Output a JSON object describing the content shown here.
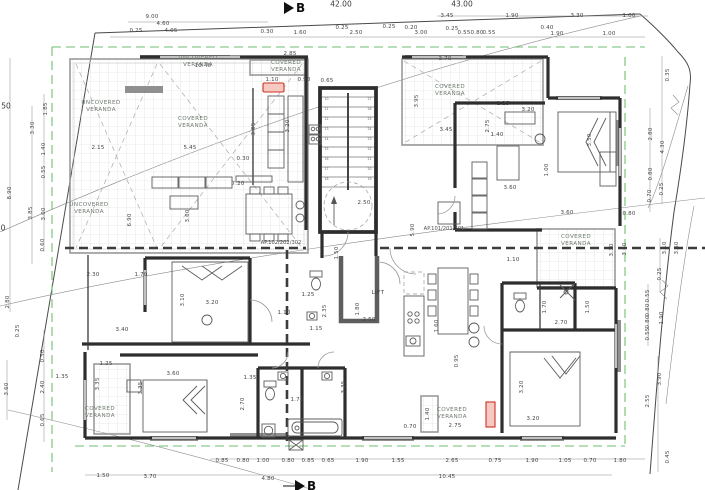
{
  "drawing": {
    "type": "architectural-floor-plan",
    "section_markers": {
      "top": {
        "label": "B"
      },
      "bottom": {
        "label": "B"
      }
    },
    "level_labels": [
      {
        "text": "42.00",
        "x": 341,
        "y": 4
      },
      {
        "text": "43.00",
        "x": 462,
        "y": 4
      },
      {
        "text": "50",
        "x": 6,
        "y": 106
      },
      {
        "text": "0",
        "x": 3,
        "y": 228
      }
    ],
    "apartment_labels": [
      {
        "text": "AP.101/201/301",
        "x": 444,
        "y": 229
      },
      {
        "text": "AP.102/202/302",
        "x": 281,
        "y": 243
      }
    ],
    "lift_label": {
      "text": "LIFT",
      "x": 378,
      "y": 293
    },
    "room_labels": [
      {
        "text": "UNCOVERED\nVERANDA",
        "x": 198,
        "y": 55
      },
      {
        "text": "UNCOVERED\nVERANDA",
        "x": 101,
        "y": 100
      },
      {
        "text": "COVERED\nVERANDA",
        "x": 193,
        "y": 116
      },
      {
        "text": "UNCOVERED\nVERANDA",
        "x": 89,
        "y": 202
      },
      {
        "text": "COVERED\nVERANDA",
        "x": 286,
        "y": 60
      },
      {
        "text": "COVERED\nVERANDA",
        "x": 450,
        "y": 84
      },
      {
        "text": "COVERED\nVERANDA",
        "x": 576,
        "y": 234
      },
      {
        "text": "COVERED\nVERANDA",
        "x": 100,
        "y": 406
      },
      {
        "text": "COVERED\nVERANDA",
        "x": 452,
        "y": 407
      }
    ],
    "stairs": {
      "left_numbers": [
        "10",
        "11",
        "12",
        "13",
        "14",
        "15",
        "16",
        "17",
        "18"
      ],
      "right_numbers": [
        "27",
        "26",
        "25",
        "24",
        "23",
        "22",
        "21",
        "20",
        "19"
      ]
    },
    "dim_labels": [
      {
        "t": "9.00",
        "x": 152,
        "y": 17
      },
      {
        "t": "4.60",
        "x": 163,
        "y": 24
      },
      {
        "t": "0.25",
        "x": 136,
        "y": 31
      },
      {
        "t": "4.05",
        "x": 171,
        "y": 31
      },
      {
        "t": "0.30",
        "x": 267,
        "y": 32
      },
      {
        "t": "1.60",
        "x": 300,
        "y": 33
      },
      {
        "t": "0.25",
        "x": 342,
        "y": 28
      },
      {
        "t": "2.50",
        "x": 356,
        "y": 33
      },
      {
        "t": "0.25",
        "x": 389,
        "y": 27
      },
      {
        "t": "0.20",
        "x": 411,
        "y": 28
      },
      {
        "t": "3.00",
        "x": 421,
        "y": 33
      },
      {
        "t": "3.45",
        "x": 447,
        "y": 16
      },
      {
        "t": "1.90",
        "x": 512,
        "y": 16
      },
      {
        "t": "3.30",
        "x": 577,
        "y": 16
      },
      {
        "t": "1.00",
        "x": 629,
        "y": 16
      },
      {
        "t": "0.25",
        "x": 452,
        "y": 29
      },
      {
        "t": "0.55",
        "x": 464,
        "y": 33
      },
      {
        "t": "0.80",
        "x": 477,
        "y": 33
      },
      {
        "t": "0.55",
        "x": 489,
        "y": 33
      },
      {
        "t": "0.40",
        "x": 547,
        "y": 28
      },
      {
        "t": "1.90",
        "x": 557,
        "y": 34
      },
      {
        "t": "1.00",
        "x": 609,
        "y": 34
      },
      {
        "t": "8.90",
        "x": 10,
        "y": 193,
        "r": 1
      },
      {
        "t": "1.85",
        "x": 46,
        "y": 109,
        "r": 1
      },
      {
        "t": "3.30",
        "x": 33,
        "y": 128,
        "r": 1
      },
      {
        "t": "1.40",
        "x": 44,
        "y": 149,
        "r": 1
      },
      {
        "t": "0.55",
        "x": 44,
        "y": 172,
        "r": 1
      },
      {
        "t": "3.85",
        "x": 31,
        "y": 213,
        "r": 1
      },
      {
        "t": "3.00",
        "x": 44,
        "y": 214,
        "r": 1
      },
      {
        "t": "0.60",
        "x": 43,
        "y": 245,
        "r": 1
      },
      {
        "t": "2.80",
        "x": 8,
        "y": 302,
        "r": 1
      },
      {
        "t": "0.25",
        "x": 18,
        "y": 331,
        "r": 1
      },
      {
        "t": "3.60",
        "x": 7,
        "y": 389,
        "r": 1
      },
      {
        "t": "0.50",
        "x": 43,
        "y": 356,
        "r": 1
      },
      {
        "t": "2.40",
        "x": 43,
        "y": 387,
        "r": 1
      },
      {
        "t": "0.65",
        "x": 43,
        "y": 420,
        "r": 1
      },
      {
        "t": "0.35",
        "x": 668,
        "y": 75,
        "r": 1
      },
      {
        "t": "2.80",
        "x": 651,
        "y": 134,
        "r": 1
      },
      {
        "t": "4.30",
        "x": 663,
        "y": 147,
        "r": 1
      },
      {
        "t": "0.80",
        "x": 651,
        "y": 174,
        "r": 1
      },
      {
        "t": "0.25",
        "x": 662,
        "y": 189,
        "r": 1
      },
      {
        "t": "0.70",
        "x": 650,
        "y": 196,
        "r": 1
      },
      {
        "t": "3.10",
        "x": 612,
        "y": 250,
        "r": 1
      },
      {
        "t": "3.60",
        "x": 625,
        "y": 249,
        "r": 1
      },
      {
        "t": "3.10",
        "x": 665,
        "y": 248,
        "r": 1
      },
      {
        "t": "3.60",
        "x": 677,
        "y": 248,
        "r": 1
      },
      {
        "t": "0.25",
        "x": 660,
        "y": 274,
        "r": 1
      },
      {
        "t": "0.55",
        "x": 648,
        "y": 296,
        "r": 1
      },
      {
        "t": "0.80",
        "x": 648,
        "y": 310,
        "r": 1
      },
      {
        "t": "0.80",
        "x": 648,
        "y": 322,
        "r": 1
      },
      {
        "t": "0.55",
        "x": 648,
        "y": 334,
        "r": 1
      },
      {
        "t": "1.90",
        "x": 662,
        "y": 318,
        "r": 1
      },
      {
        "t": "3.90",
        "x": 660,
        "y": 379,
        "r": 1
      },
      {
        "t": "2.55",
        "x": 648,
        "y": 401,
        "r": 1
      },
      {
        "t": "0.45",
        "x": 668,
        "y": 457,
        "r": 1
      },
      {
        "t": "0.85",
        "x": 222,
        "y": 461
      },
      {
        "t": "0.80",
        "x": 243,
        "y": 461
      },
      {
        "t": "1.00",
        "x": 263,
        "y": 461
      },
      {
        "t": "0.80",
        "x": 288,
        "y": 461
      },
      {
        "t": "0.85",
        "x": 308,
        "y": 461
      },
      {
        "t": "0.65",
        "x": 328,
        "y": 461
      },
      {
        "t": "1.90",
        "x": 362,
        "y": 461
      },
      {
        "t": "1.55",
        "x": 398,
        "y": 461
      },
      {
        "t": "2.65",
        "x": 452,
        "y": 461
      },
      {
        "t": "0.75",
        "x": 495,
        "y": 461
      },
      {
        "t": "1.90",
        "x": 532,
        "y": 461
      },
      {
        "t": "1.05",
        "x": 565,
        "y": 461
      },
      {
        "t": "0.70",
        "x": 590,
        "y": 461
      },
      {
        "t": "1.80",
        "x": 620,
        "y": 461
      },
      {
        "t": "1.50",
        "x": 103,
        "y": 476
      },
      {
        "t": "3.70",
        "x": 150,
        "y": 477
      },
      {
        "t": "4.80",
        "x": 268,
        "y": 479
      },
      {
        "t": "10.45",
        "x": 447,
        "y": 477
      },
      {
        "t": "10.40",
        "x": 203,
        "y": 66
      },
      {
        "t": "2.85",
        "x": 290,
        "y": 54
      },
      {
        "t": "1.10",
        "x": 272,
        "y": 80
      },
      {
        "t": "0.90",
        "x": 304,
        "y": 80
      },
      {
        "t": "0.65",
        "x": 327,
        "y": 81
      },
      {
        "t": "3.70",
        "x": 445,
        "y": 59
      },
      {
        "t": "2.15",
        "x": 98,
        "y": 148
      },
      {
        "t": "5.45",
        "x": 190,
        "y": 148
      },
      {
        "t": "0.30",
        "x": 243,
        "y": 159
      },
      {
        "t": "7.20",
        "x": 238,
        "y": 184
      },
      {
        "t": "6.90",
        "x": 130,
        "y": 220,
        "r": 1
      },
      {
        "t": "3.05",
        "x": 254,
        "y": 129,
        "r": 1
      },
      {
        "t": "3.20",
        "x": 288,
        "y": 126,
        "r": 1
      },
      {
        "t": "3.60",
        "x": 188,
        "y": 216,
        "r": 1
      },
      {
        "t": "3.95",
        "x": 417,
        "y": 101,
        "r": 1
      },
      {
        "t": "3.45",
        "x": 446,
        "y": 130
      },
      {
        "t": "1.25",
        "x": 503,
        "y": 104
      },
      {
        "t": "2.75",
        "x": 488,
        "y": 126,
        "r": 1
      },
      {
        "t": "1.40",
        "x": 497,
        "y": 135
      },
      {
        "t": "3.20",
        "x": 528,
        "y": 110
      },
      {
        "t": "3.50",
        "x": 590,
        "y": 140,
        "r": 1
      },
      {
        "t": "1.00",
        "x": 547,
        "y": 170,
        "r": 1
      },
      {
        "t": "3.60",
        "x": 510,
        "y": 188
      },
      {
        "t": "3.60",
        "x": 567,
        "y": 213
      },
      {
        "t": "0.80",
        "x": 629,
        "y": 214
      },
      {
        "t": "2.30",
        "x": 93,
        "y": 275
      },
      {
        "t": "1.70",
        "x": 141,
        "y": 275
      },
      {
        "t": "3.10",
        "x": 183,
        "y": 300,
        "r": 1
      },
      {
        "t": "3.20",
        "x": 212,
        "y": 303
      },
      {
        "t": "3.40",
        "x": 122,
        "y": 330
      },
      {
        "t": "1.10",
        "x": 284,
        "y": 313
      },
      {
        "t": "1.25",
        "x": 308,
        "y": 295
      },
      {
        "t": "2.35",
        "x": 325,
        "y": 311,
        "r": 1
      },
      {
        "t": "1.15",
        "x": 316,
        "y": 329
      },
      {
        "t": "1.10",
        "x": 513,
        "y": 260
      },
      {
        "t": "1.70",
        "x": 545,
        "y": 307,
        "r": 1
      },
      {
        "t": "1.50",
        "x": 588,
        "y": 307,
        "r": 1
      },
      {
        "t": "2.70",
        "x": 561,
        "y": 323
      },
      {
        "t": "2.50",
        "x": 364,
        "y": 203
      },
      {
        "t": "5.90",
        "x": 413,
        "y": 230,
        "r": 1
      },
      {
        "t": "1.50",
        "x": 337,
        "y": 253,
        "r": 1
      },
      {
        "t": "1.80",
        "x": 358,
        "y": 309,
        "r": 1
      },
      {
        "t": "2.50",
        "x": 369,
        "y": 320
      },
      {
        "t": "1.60",
        "x": 437,
        "y": 326,
        "r": 1
      },
      {
        "t": "0.95",
        "x": 457,
        "y": 361,
        "r": 1
      },
      {
        "t": "1.25",
        "x": 106,
        "y": 364
      },
      {
        "t": "3.35",
        "x": 98,
        "y": 384,
        "r": 1
      },
      {
        "t": "3.35",
        "x": 141,
        "y": 388,
        "r": 1
      },
      {
        "t": "3.60",
        "x": 173,
        "y": 374
      },
      {
        "t": "1.35",
        "x": 62,
        "y": 377
      },
      {
        "t": "1.35",
        "x": 250,
        "y": 378
      },
      {
        "t": "2.70",
        "x": 243,
        "y": 404,
        "r": 1
      },
      {
        "t": "1.75",
        "x": 297,
        "y": 400
      },
      {
        "t": "3.35",
        "x": 344,
        "y": 387,
        "r": 1
      },
      {
        "t": "3.20",
        "x": 522,
        "y": 387,
        "r": 1
      },
      {
        "t": "3.20",
        "x": 533,
        "y": 419
      },
      {
        "t": "1.40",
        "x": 428,
        "y": 414,
        "r": 1
      },
      {
        "t": "2.75",
        "x": 455,
        "y": 426
      },
      {
        "t": "0.70",
        "x": 410,
        "y": 427
      }
    ],
    "colors": {
      "wall": "#2e2e2e",
      "slab_edge": "#9a9a9a",
      "grid_line": "#d4d4d4",
      "setback_green": "#6fbf6f",
      "highlight_red": "#cc3322",
      "dim_text": "#454545",
      "room_text": "#6e7a6e"
    }
  }
}
